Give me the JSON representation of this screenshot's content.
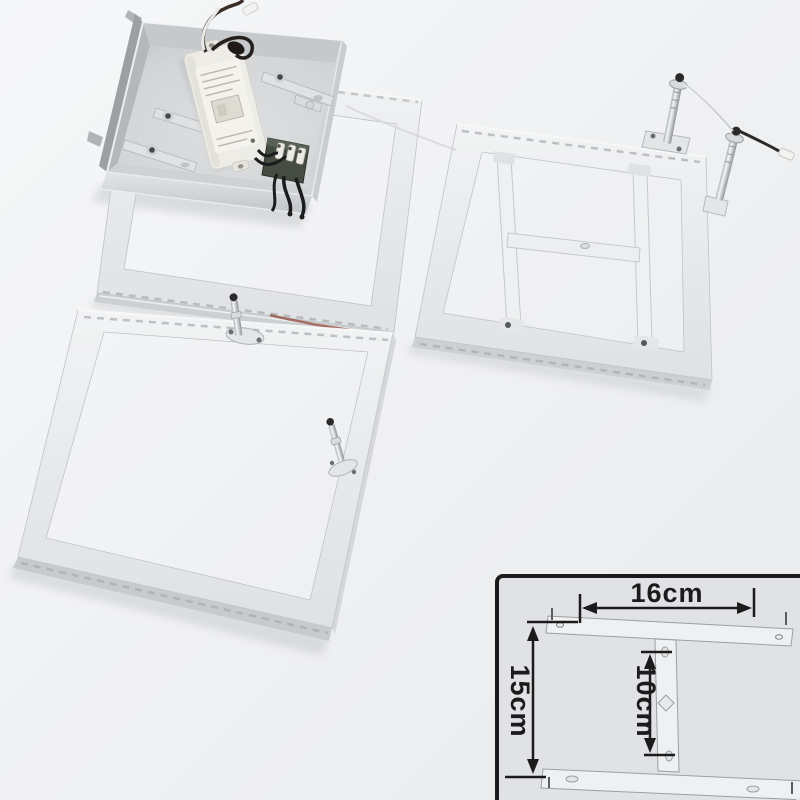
{
  "inset": {
    "width_label": "16cm",
    "height_label": "15cm",
    "inner_height_label": "10cm"
  },
  "colors": {
    "background_top": "#f6f7f8",
    "background_bottom": "#e8eaec",
    "inset_background": "#e0e2e5",
    "inset_border": "#1b1b1b",
    "dimension_text": "#1b1b1b",
    "metal_light": "#eff0f1",
    "metal_mid": "#c8cbce",
    "metal_dark": "#9aa0a4",
    "driver_body": "#edece7",
    "terminal_block": "#454c42",
    "wire_dark": "#241f1c"
  }
}
